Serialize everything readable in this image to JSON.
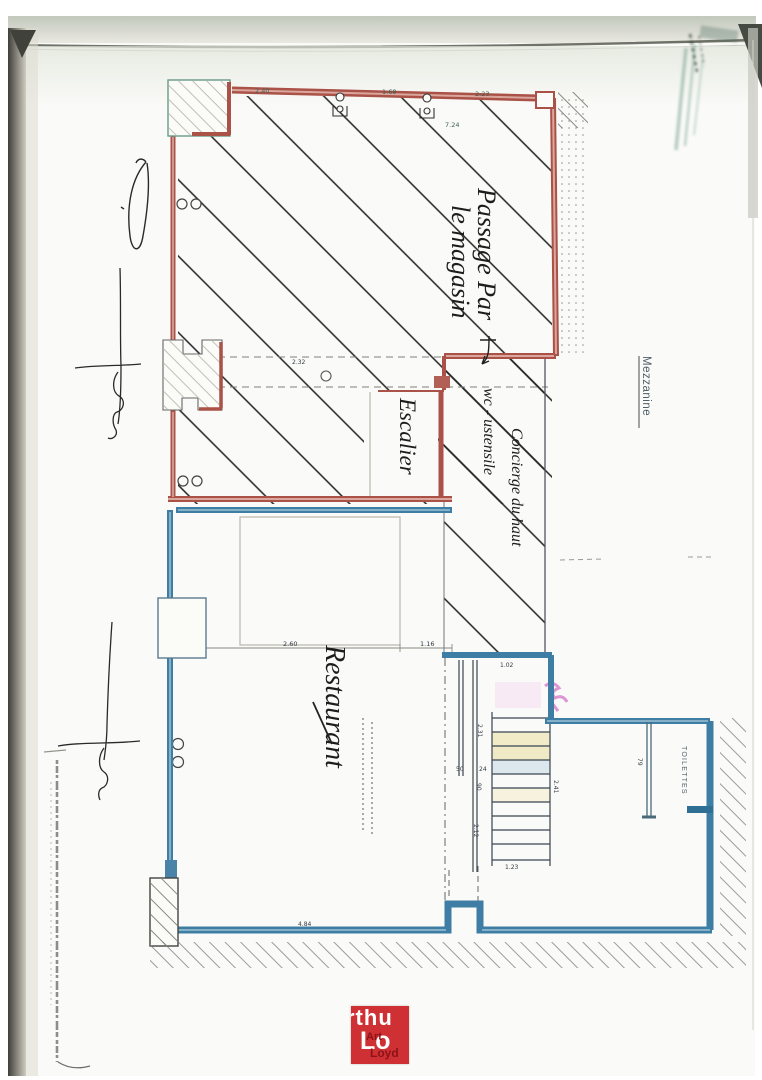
{
  "labels": {
    "passage_line1": "Passage Par",
    "passage_line2": "le magasin",
    "escalier": "Escalier",
    "wc_line": "wc - ustensile",
    "concierge_line": "Concierge du haut",
    "restaurant": "Restaurant",
    "mezzanine": "Mezzanine",
    "toilettes": "TOILETTES"
  },
  "dims": {
    "top": [
      "2.40",
      "1.68",
      "2.23"
    ],
    "top_total": "7.24",
    "inner_width": "2.32",
    "rest_left": "2.60",
    "rest_right": "1.16",
    "landing_w": "1.02",
    "landing_h": "2.31",
    "step_a": "50",
    "step_b": "24",
    "step_c": "90",
    "stair_len": "2.41",
    "stair_mid": "2.12",
    "stair_bottom": "1.23",
    "bottom_wall": "4.84",
    "toilet_w": "79"
  },
  "logo": {
    "fragment_top": "rthu",
    "fragment_mid": "Lo",
    "small_top": "Art",
    "small_bottom": "Loyd"
  },
  "colors": {
    "wall_red": "#aa5148",
    "wall_blue": "#3f7ea4",
    "logo_red": "#cf3034",
    "highlight_pink": "#d884cc",
    "paper": "#fafaf8"
  }
}
